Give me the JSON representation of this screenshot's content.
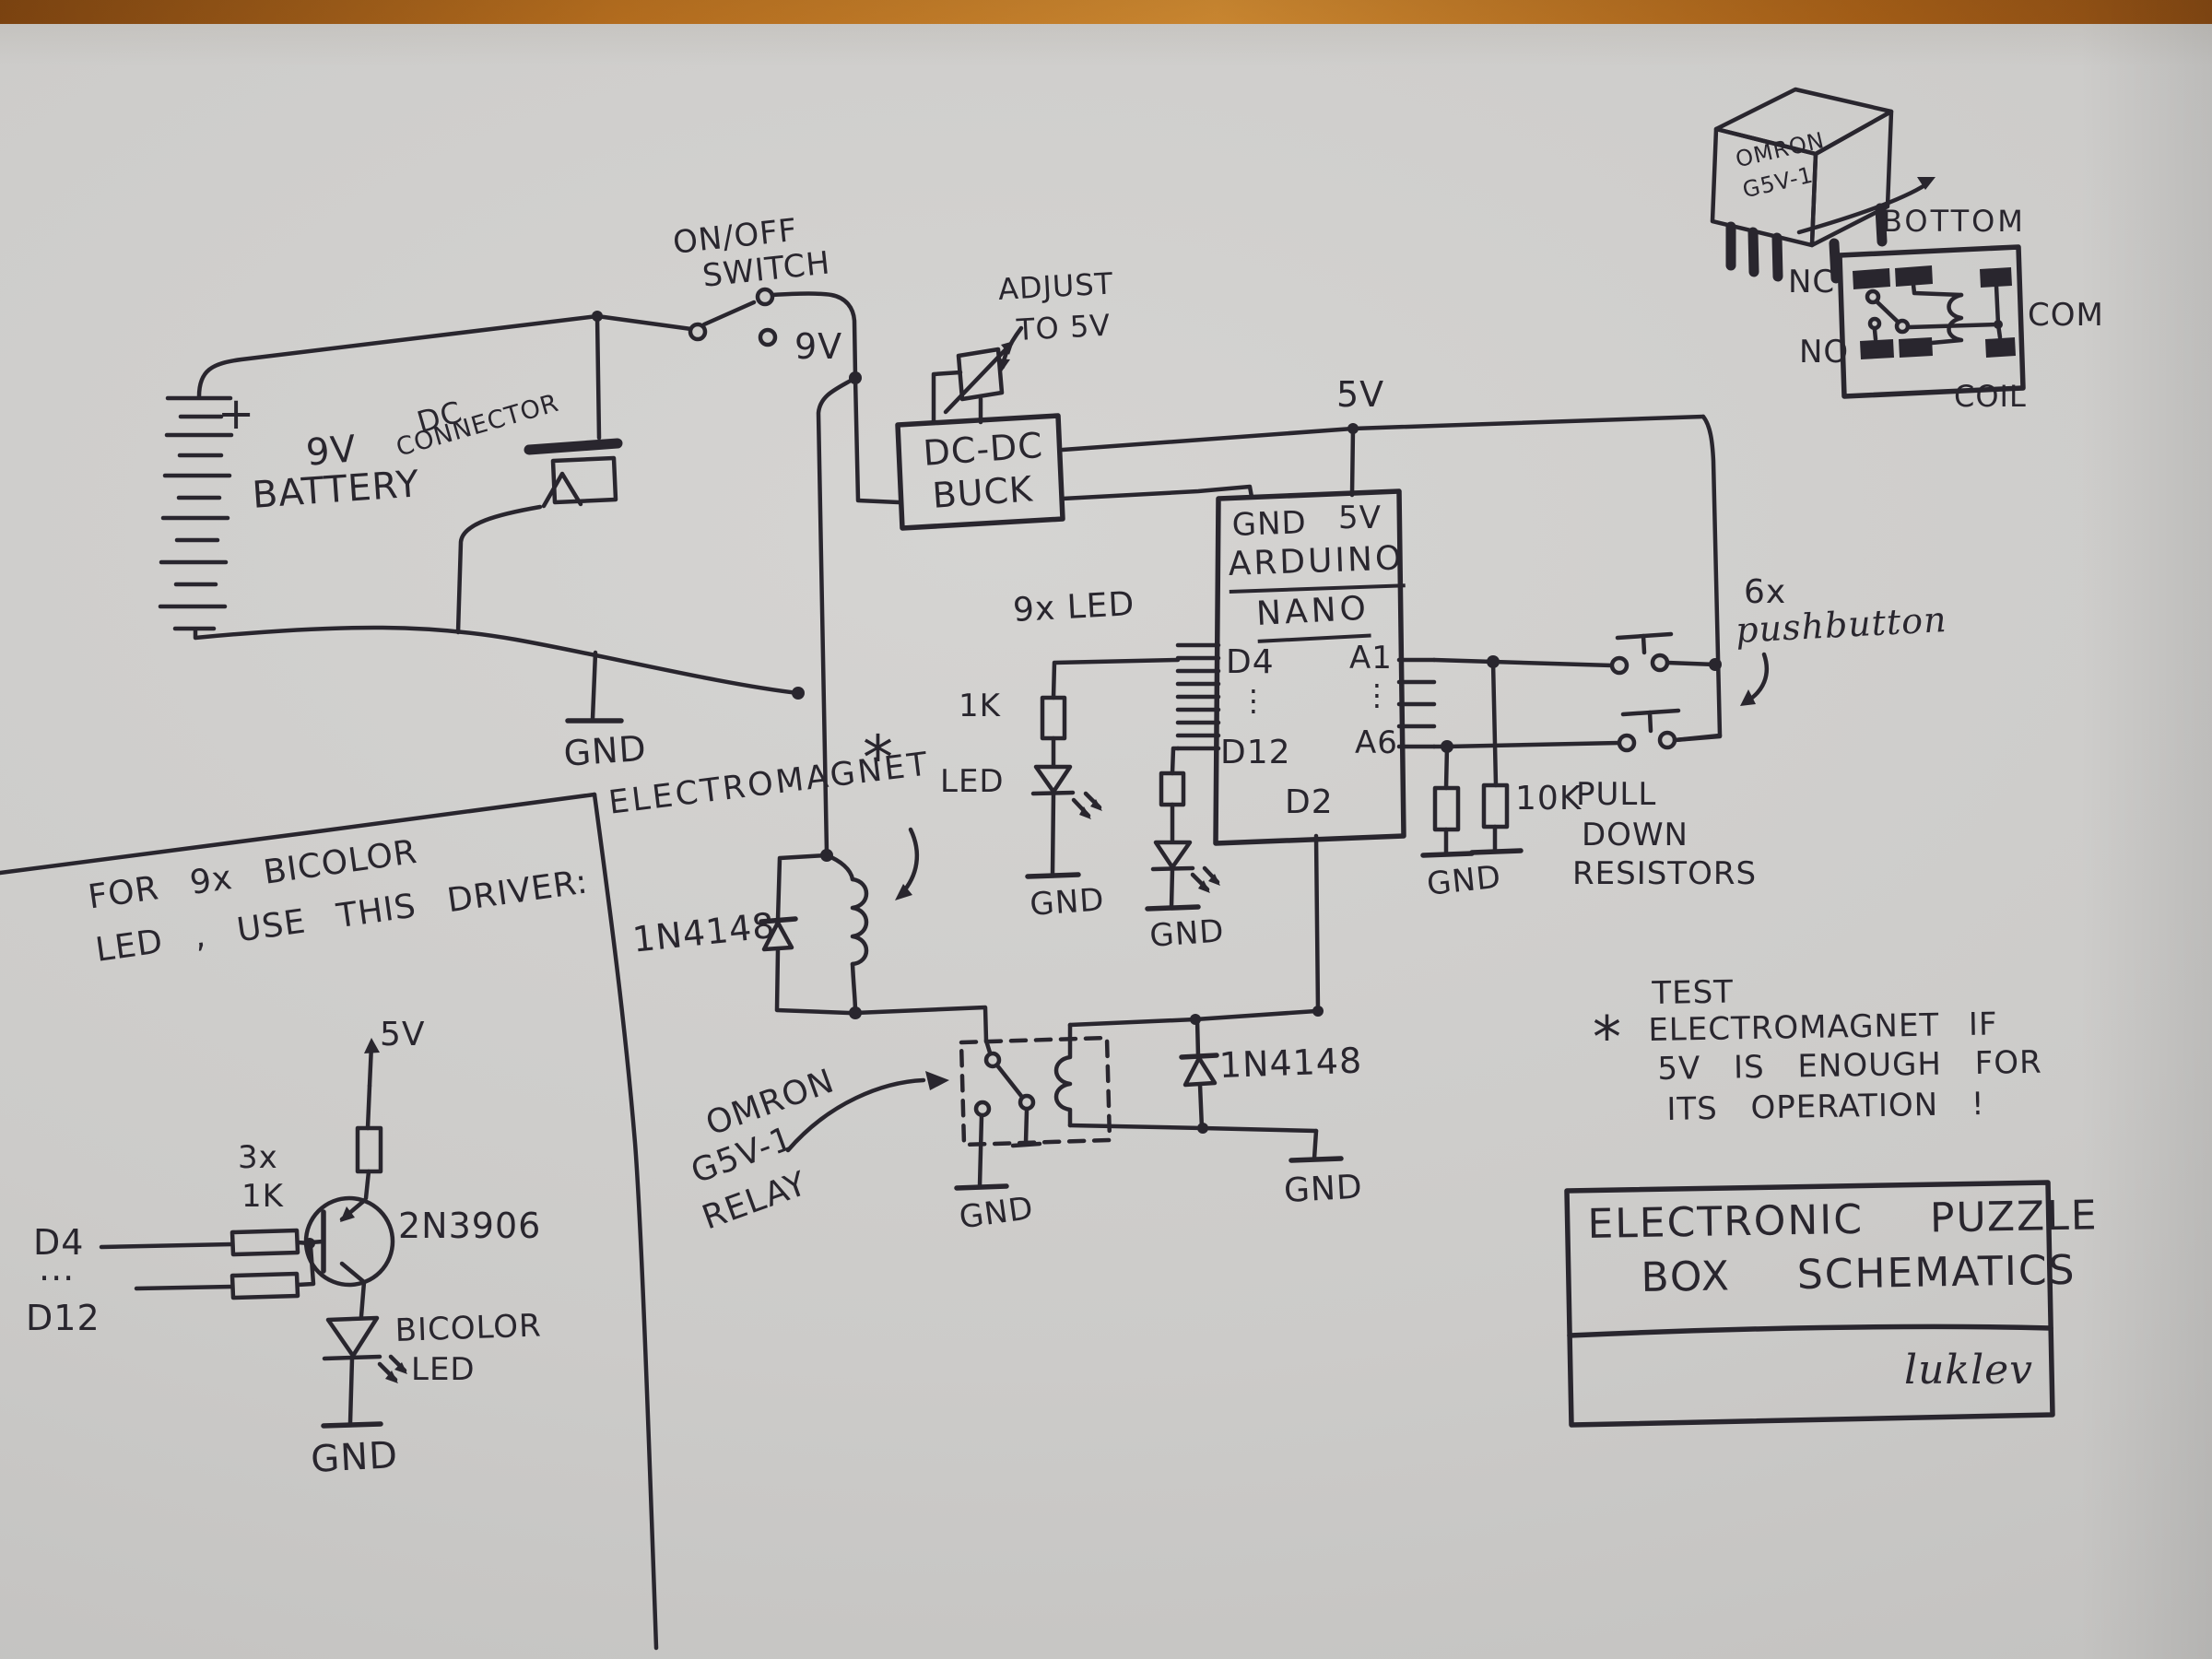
{
  "common": {
    "gnd": "GND"
  },
  "power": {
    "battery_plus": "+",
    "battery_line1": "9V",
    "battery_line2": "BATTERY",
    "dc_conn_line1": "DC",
    "dc_conn_line2": "CONNECTOR",
    "switch_line1": "ON/OFF",
    "switch_line2": "SWITCH",
    "v9": "9V"
  },
  "buck": {
    "line1": "DC-DC",
    "line2": "BUCK",
    "adjust1": "ADJUST",
    "adjust2": "TO 5V",
    "rail5v": "5V"
  },
  "arduino": {
    "gnd": "GND",
    "v5": "5V",
    "name1": "ARDUINO",
    "name2": "NANO",
    "d4": "D4",
    "d12": "D12",
    "a1": "A1",
    "a6": "A6",
    "d2": "D2",
    "dots": "⋮"
  },
  "leds": {
    "group": "9x LED",
    "r1k": "1K",
    "led": "LED"
  },
  "magnet": {
    "label": "ELECTROMAGNET",
    "star": "*",
    "diode": "1N4148"
  },
  "relay": {
    "line1": "OMRON",
    "line2": "G5V-1",
    "line3": "RELAY",
    "diode": "1N4148"
  },
  "buttons": {
    "count": "6x",
    "label": "pushbutton",
    "value": "10K",
    "pull1": "PULL",
    "pull2": "DOWN",
    "pull3": "RESISTORS"
  },
  "relay_detail": {
    "name": "OMRON\nG5V-1",
    "view": "BOTTOM",
    "nc": "NC",
    "no": "NO",
    "com": "COM",
    "coil": "COIL"
  },
  "driver": {
    "note": "FOR 9x BICOLOR\nLED , USE THIS DRIVER:",
    "v5": "5V",
    "qty": "3x",
    "r1k": "1K",
    "d4": "D4",
    "dots": "...",
    "d12": "D12",
    "part": "2N3906",
    "led1": "BICOLOR",
    "led2": "LED"
  },
  "note": {
    "star": "*",
    "l1": "TEST",
    "l2": "ELECTROMAGNET IF",
    "l3": "5V IS ENOUGH FOR",
    "l4": "ITS OPERATION !"
  },
  "title_block": {
    "row1": "ELECTRONIC PUZZLE",
    "row2": "BOX SCHEMATICS",
    "author": "luklev"
  }
}
